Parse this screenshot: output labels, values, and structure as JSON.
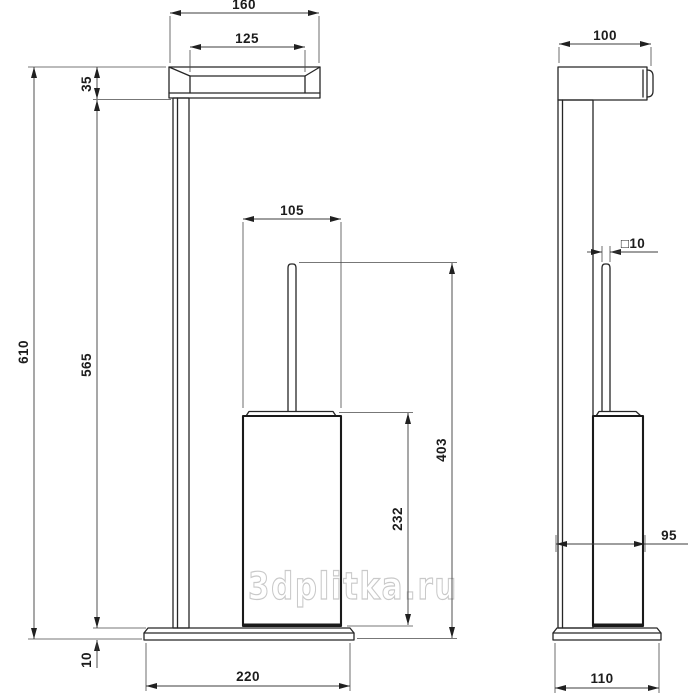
{
  "watermark": "3dplitka.ru",
  "drawing": {
    "description": "technical dimensional drawing, freestanding toilet paper holder with brush, front and side views",
    "front_view": {
      "paper_holder_width": "160",
      "paper_roll_width": "125",
      "paper_holder_height": "35",
      "total_height": "610",
      "post_height": "565",
      "brush_cup_width": "105",
      "cup_height": "232",
      "brush_assembly_height": "403",
      "base_height": "10",
      "base_width": "220"
    },
    "side_view": {
      "top_depth": "100",
      "handle_square_section": "□10",
      "unit_depth": "95",
      "base_depth": "110"
    }
  }
}
